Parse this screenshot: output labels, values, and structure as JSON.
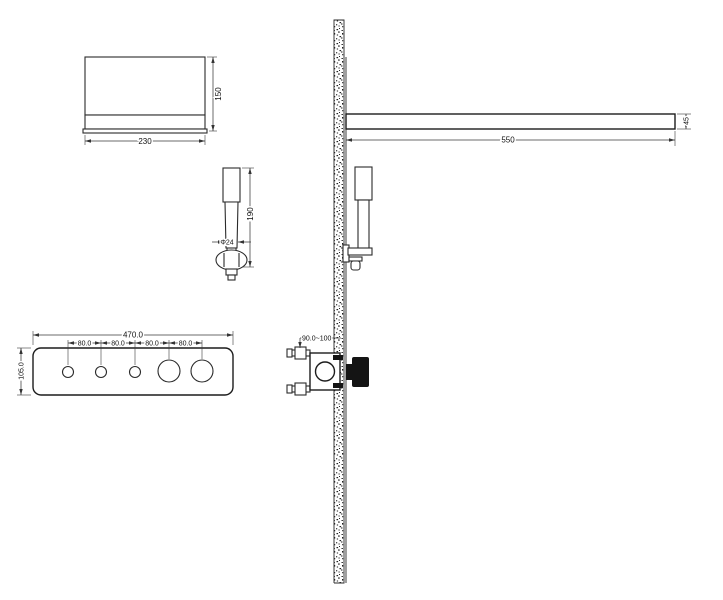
{
  "colors": {
    "line": "#1a1a1a",
    "background": "#ffffff"
  },
  "dimensions": {
    "shower_head": {
      "width": "230",
      "height": "150"
    },
    "hand_shower": {
      "length": "190",
      "diameter": "Φ24"
    },
    "control_panel": {
      "width": "470.0",
      "height": "105.0",
      "spacings": [
        "80.0",
        "80.0",
        "80.0",
        "80.0"
      ]
    },
    "shower_arm": {
      "length": "550",
      "thickness": "45"
    },
    "valve": {
      "installation_depth": "90.0~100"
    }
  }
}
